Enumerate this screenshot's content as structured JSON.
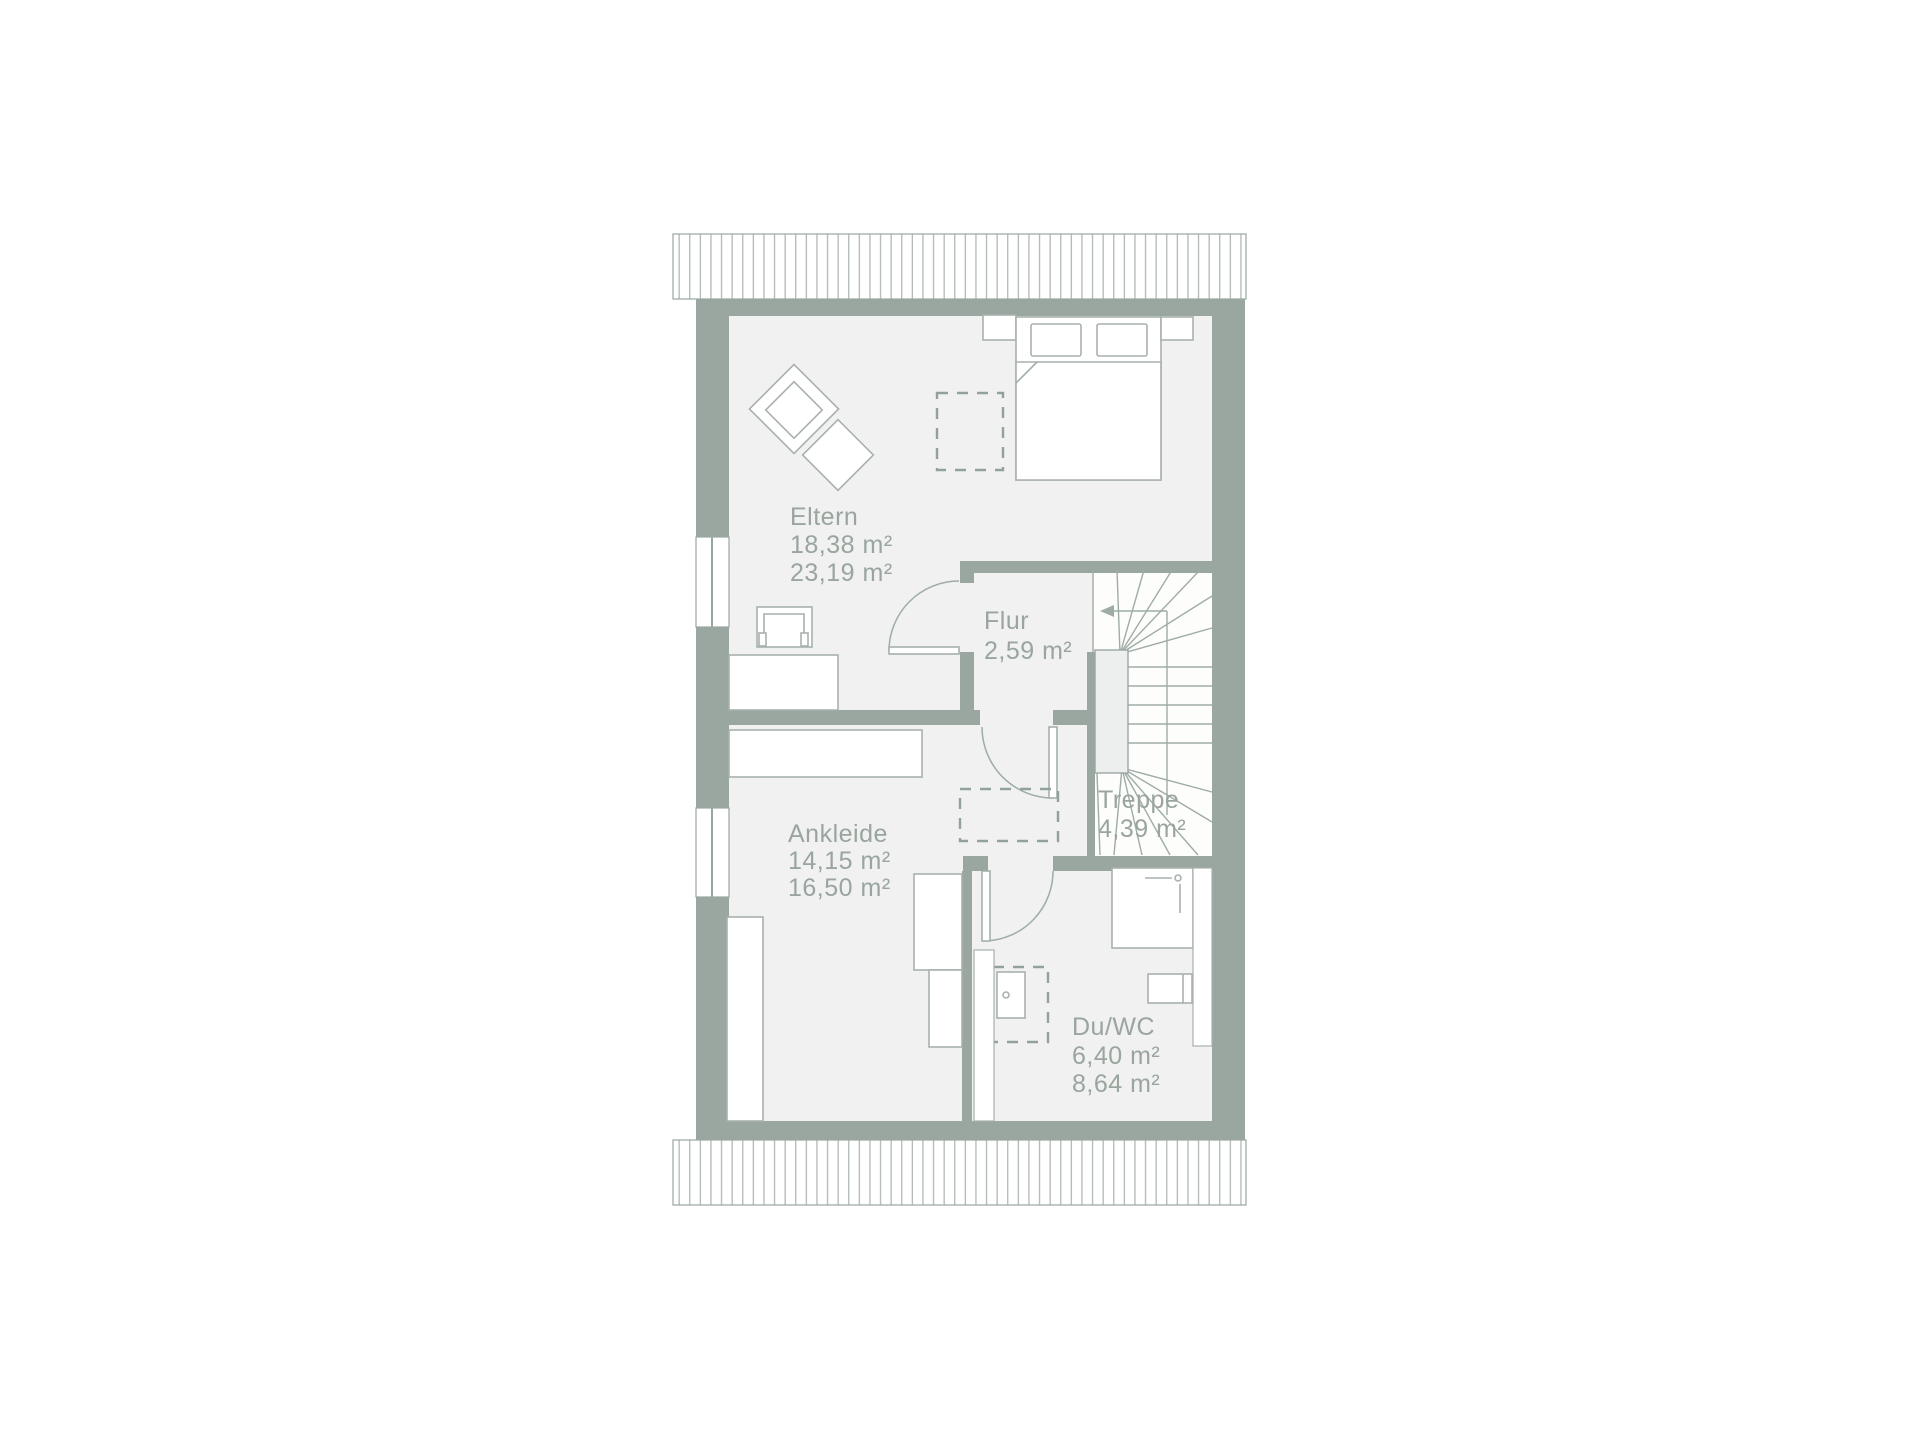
{
  "floorplan": {
    "title": "Dachgeschoss Grundriss",
    "rooms": [
      {
        "name": "Eltern",
        "area_line1": "18,38 m²",
        "area_line2": "23,19 m²"
      },
      {
        "name": "Flur",
        "area_line1": "2,59 m²",
        "area_line2": ""
      },
      {
        "name": "Treppe",
        "area_line1": "4,39 m²",
        "area_line2": ""
      },
      {
        "name": "Ankleide",
        "area_line1": "14,15 m²",
        "area_line2": "16,50 m²"
      },
      {
        "name": "Du/WC",
        "area_line1": "6,40 m²",
        "area_line2": "8,64 m²"
      }
    ],
    "icons": [
      {
        "name": "stairs-direction-arrow",
        "meaning": "walk direction up the stairs"
      }
    ],
    "colors": {
      "wall": "#9AA7A1",
      "floor": "#F0F1F0",
      "furniture_line": "#A8B1AC",
      "thin_line": "#9FACA6",
      "text": "#99A59E",
      "hatch_line": "#AAB4AF",
      "paper": "#FFFFFF"
    }
  }
}
